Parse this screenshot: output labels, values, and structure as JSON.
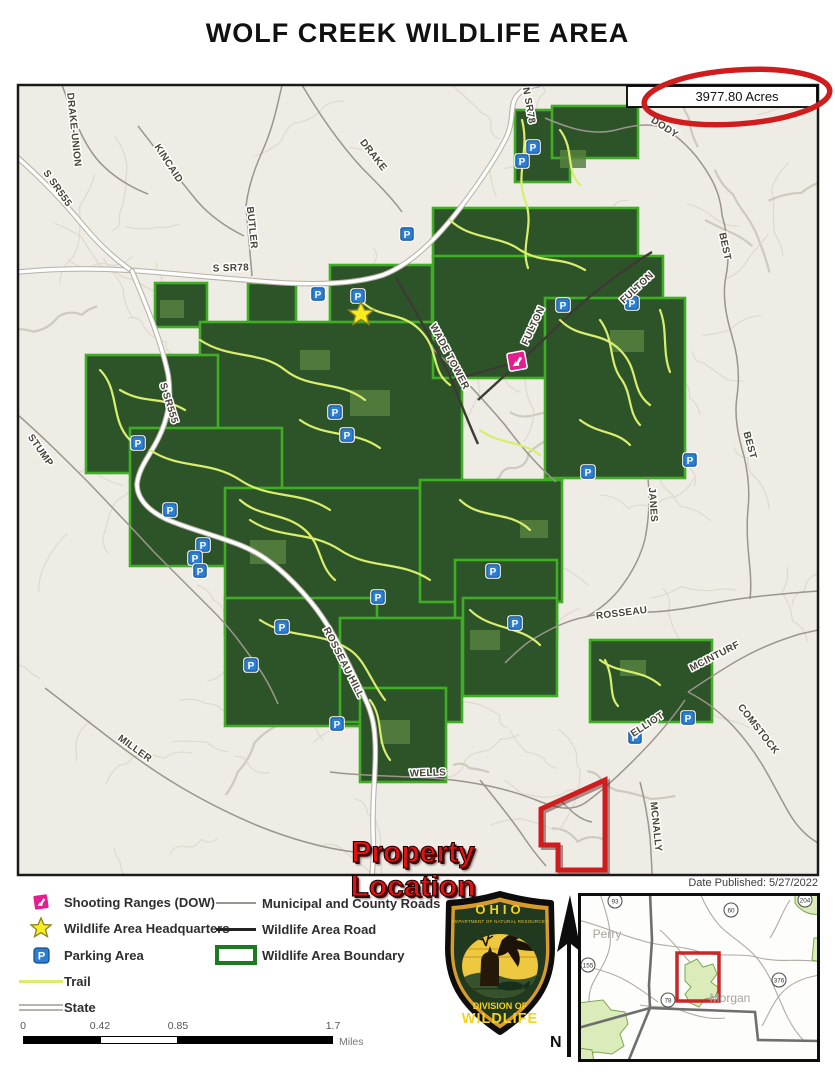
{
  "title": "WOLF CREEK WILDLIFE AREA",
  "acres_label": "3977.80 Acres",
  "date_published": "Date Published: 5/27/2022",
  "property_location_label": "Property Location",
  "north_label": "N",
  "colors": {
    "area_green": "#2d5429",
    "boundary_green": "#3fae25",
    "trail": "#dff07a",
    "accent_red": "#cf1d1d",
    "parking_blue": "#2a7fd4",
    "star_yellow": "#f9ec1f",
    "shooting_magenta": "#e31f8f",
    "terrain_bg": "#efece6"
  },
  "legend": {
    "items_left": [
      {
        "icon": "shooting-range",
        "label": "Shooting Ranges (DOW)"
      },
      {
        "icon": "headquarters-star",
        "label": "Wildlife Area Headquarters"
      },
      {
        "icon": "parking",
        "label": "Parking Area"
      },
      {
        "icon": "trail",
        "label": "Trail"
      },
      {
        "icon": "state",
        "label": "State"
      }
    ],
    "items_right": [
      {
        "icon": "municipal-road",
        "label": "Municipal and County Roads"
      },
      {
        "icon": "wildlife-road",
        "label": "Wildlife Area Road"
      },
      {
        "icon": "boundary",
        "label": "Wildlife Area Boundary"
      }
    ]
  },
  "scalebar": {
    "labels": [
      "0",
      "0.42",
      "0.85",
      "1.7"
    ],
    "unit": "Miles"
  },
  "logo": {
    "state": "OHIO",
    "dept": "DEPARTMENT OF NATURAL RESOURCES",
    "division_line1": "DIVISION OF",
    "division_line2": "WILDLIFE"
  },
  "inset": {
    "counties": [
      {
        "name": "Perry",
        "x": 607,
        "y": 938
      },
      {
        "name": "Morgan",
        "x": 730,
        "y": 1002
      }
    ],
    "routes": [
      {
        "n": "93",
        "x": 615,
        "y": 901
      },
      {
        "n": "60",
        "x": 731,
        "y": 910
      },
      {
        "n": "204",
        "x": 805,
        "y": 900
      },
      {
        "n": "155",
        "x": 588,
        "y": 965
      },
      {
        "n": "376",
        "x": 779,
        "y": 980
      },
      {
        "n": "78",
        "x": 668,
        "y": 1000
      }
    ]
  },
  "map": {
    "road_labels": [
      {
        "t": "DRAKE-UNION",
        "x": 71,
        "y": 130,
        "r": 84
      },
      {
        "t": "S SR555",
        "x": 55,
        "y": 190,
        "r": 55
      },
      {
        "t": "KINCAID",
        "x": 166,
        "y": 165,
        "r": 57
      },
      {
        "t": "BUTLER",
        "x": 249,
        "y": 228,
        "r": 84
      },
      {
        "t": "DRAKE",
        "x": 371,
        "y": 157,
        "r": 52
      },
      {
        "t": "S SR78",
        "x": 231,
        "y": 271,
        "r": -2
      },
      {
        "t": "N SR78",
        "x": 526,
        "y": 106,
        "r": 80
      },
      {
        "t": "DODY",
        "x": 663,
        "y": 130,
        "r": 33
      },
      {
        "t": "BEST",
        "x": 722,
        "y": 247,
        "r": 78
      },
      {
        "t": "BEST",
        "x": 747,
        "y": 446,
        "r": 75
      },
      {
        "t": "FULTON",
        "x": 639,
        "y": 290,
        "r": -43
      },
      {
        "t": "FULTON",
        "x": 536,
        "y": 327,
        "r": -65
      },
      {
        "t": "WADE TOWER",
        "x": 447,
        "y": 358,
        "r": 62
      },
      {
        "t": "JANES",
        "x": 650,
        "y": 505,
        "r": 86
      },
      {
        "t": "ROSSEAU",
        "x": 622,
        "y": 616,
        "r": -7
      },
      {
        "t": "MCINTURF",
        "x": 716,
        "y": 659,
        "r": -27
      },
      {
        "t": "COMSTOCK",
        "x": 756,
        "y": 731,
        "r": 52
      },
      {
        "t": "MCNALLY",
        "x": 653,
        "y": 827,
        "r": 84
      },
      {
        "t": "ELLIOT",
        "x": 649,
        "y": 727,
        "r": -33
      },
      {
        "t": "WELLS",
        "x": 428,
        "y": 776,
        "r": -2
      },
      {
        "t": "ROSSEAU HILL",
        "x": 341,
        "y": 664,
        "r": 63
      },
      {
        "t": "S SR555",
        "x": 166,
        "y": 404,
        "r": 73
      },
      {
        "t": "STUMP",
        "x": 38,
        "y": 452,
        "r": 55
      },
      {
        "t": "MILLER",
        "x": 133,
        "y": 751,
        "r": 36
      }
    ],
    "parking": [
      [
        533,
        147
      ],
      [
        522,
        161
      ],
      [
        407,
        234
      ],
      [
        318,
        294
      ],
      [
        358,
        296
      ],
      [
        563,
        305
      ],
      [
        632,
        303
      ],
      [
        690,
        460
      ],
      [
        588,
        472
      ],
      [
        138,
        443
      ],
      [
        170,
        510
      ],
      [
        335,
        412
      ],
      [
        347,
        435
      ],
      [
        203,
        545
      ],
      [
        195,
        558
      ],
      [
        200,
        571
      ],
      [
        282,
        627
      ],
      [
        251,
        665
      ],
      [
        337,
        724
      ],
      [
        515,
        623
      ],
      [
        493,
        571
      ],
      [
        378,
        597
      ],
      [
        635,
        737
      ],
      [
        688,
        718
      ]
    ],
    "headquarters": {
      "x": 361,
      "y": 314
    },
    "shooting_range": {
      "x": 517,
      "y": 361
    }
  }
}
